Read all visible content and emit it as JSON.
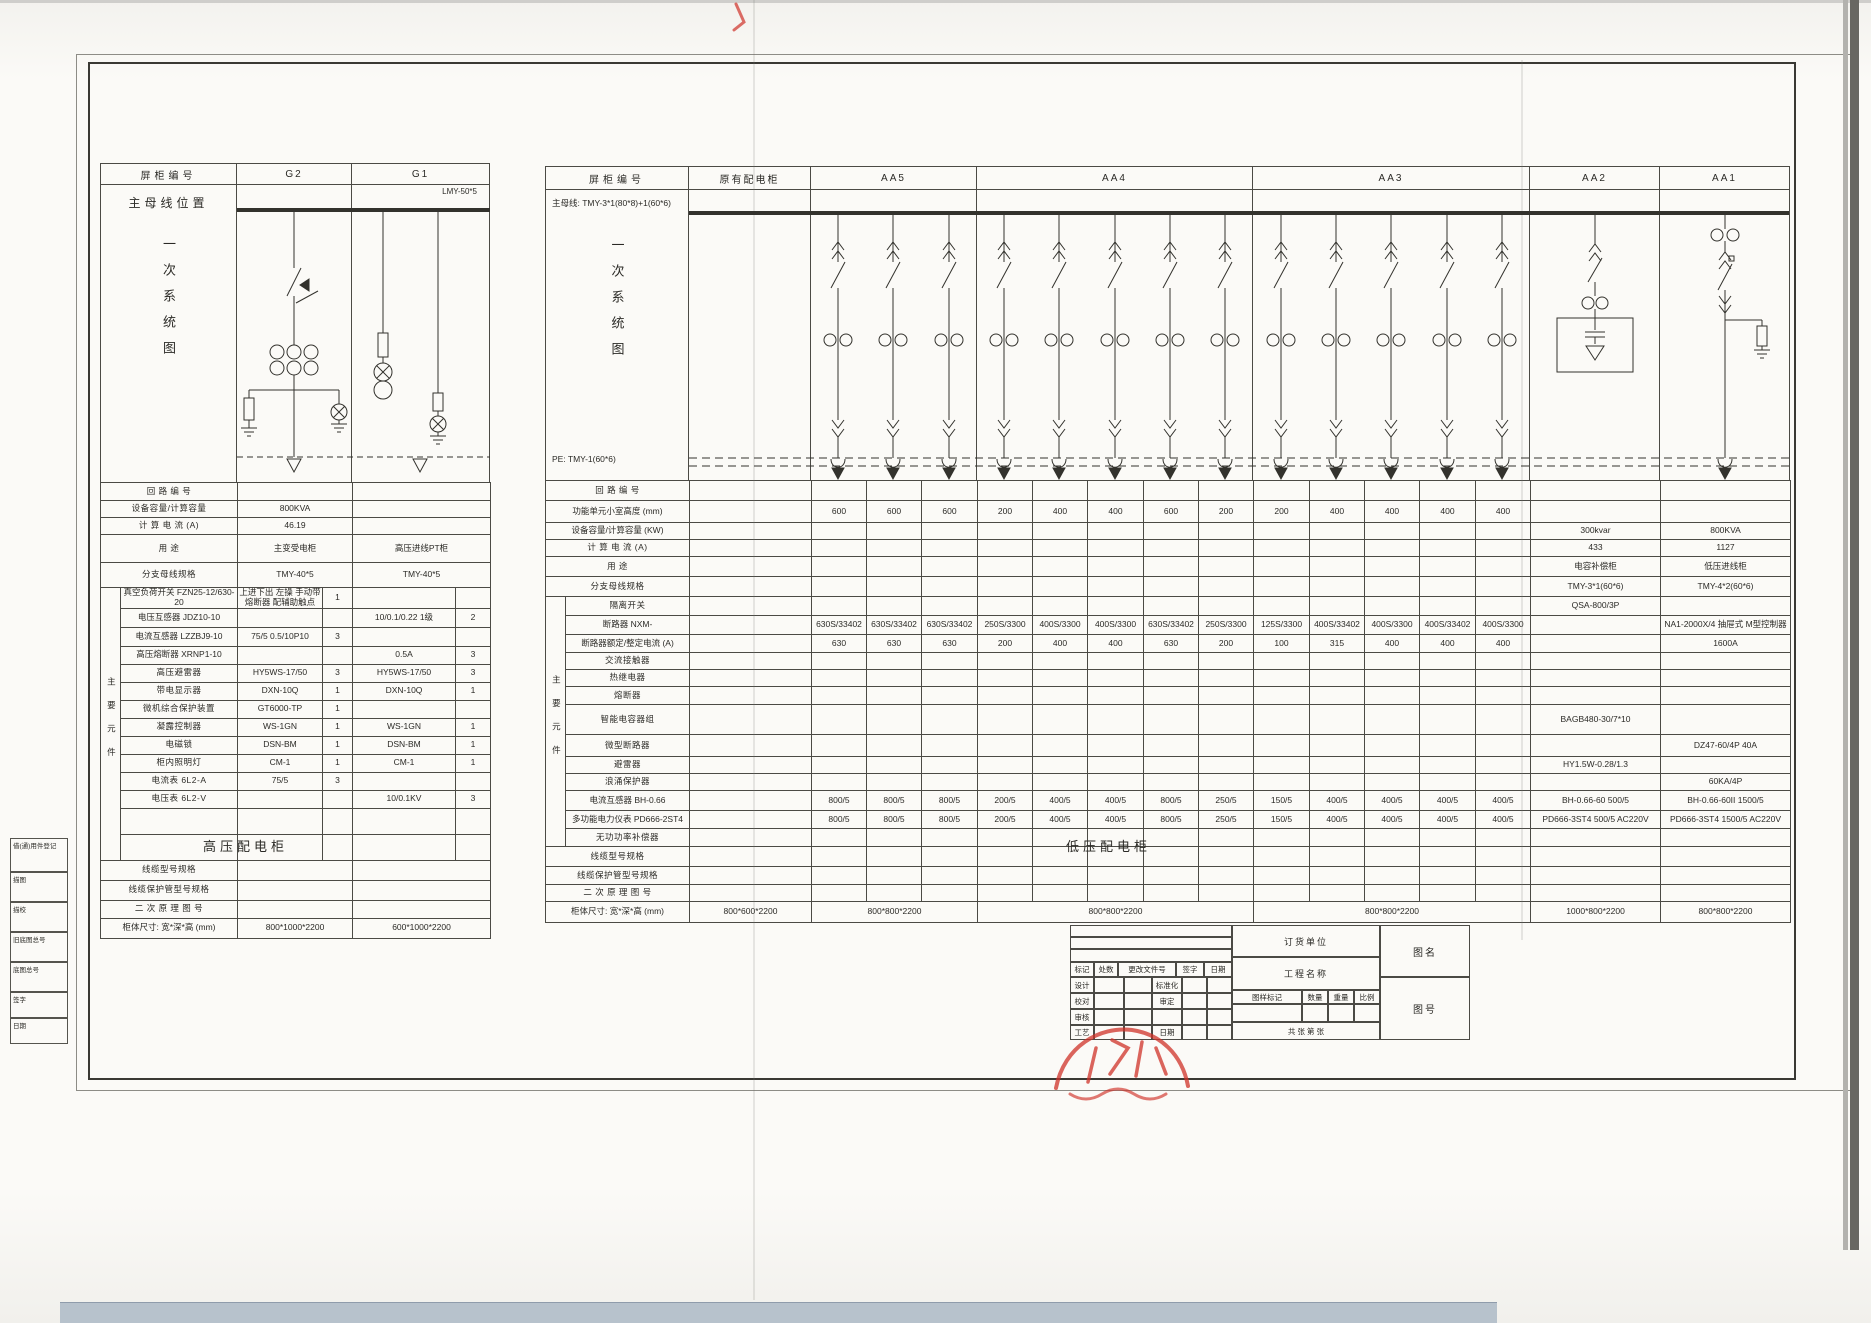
{
  "captions": {
    "hv": "高压配电柜",
    "lv": "低压配电柜"
  },
  "hv": {
    "header": {
      "col_label": "屏柜编号",
      "g2": "G2",
      "g1": "G1"
    },
    "busbar_position_label": "主母线位置",
    "busbar_tag": "LMY-50*5",
    "vertical_title": "一次系统图",
    "group_label": "主要元件",
    "rows": [
      {
        "type": "plain",
        "label": "回 路 编 号",
        "g2": "",
        "g1": "",
        "h": 18
      },
      {
        "type": "plain",
        "label": "设备容量/计算容量",
        "g2": "800KVA",
        "g1": "",
        "h": 17
      },
      {
        "type": "plain",
        "label": "计 算 电 流 (A)",
        "g2": "46.19",
        "g1": "",
        "h": 17
      },
      {
        "type": "plain",
        "label": "用  途",
        "g2": "主变受电柜",
        "g1": "高压进线PT柜",
        "h": 28
      },
      {
        "type": "plain",
        "label": "分支母线规格",
        "g2": "TMY-40*5",
        "g1": "TMY-40*5",
        "h": 25
      },
      {
        "type": "comp",
        "label": "真空负荷开关  FZN25-12/630-20",
        "g2": "上进下出 左操 手动带熔断器 配辅助触点",
        "g2q": "1",
        "g1": "",
        "g1q": "",
        "h": 19,
        "small": true
      },
      {
        "type": "comp",
        "label": "电压互感器  JDZ10-10",
        "g2": "",
        "g2q": "",
        "g1": "10/0.1/0.22 1级",
        "g1q": "2",
        "h": 19
      },
      {
        "type": "comp",
        "label": "电流互感器  LZZBJ9-10",
        "g2": "75/5 0.5/10P10",
        "g2q": "3",
        "g1": "",
        "g1q": "",
        "h": 19
      },
      {
        "type": "comp",
        "label": "高压熔断器  XRNP1-10",
        "g2": "",
        "g2q": "",
        "g1": "0.5A",
        "g1q": "3",
        "h": 18
      },
      {
        "type": "comp",
        "label": "高压避雷器",
        "g2": "HY5WS-17/50",
        "g2q": "3",
        "g1": "HY5WS-17/50",
        "g1q": "3",
        "h": 18
      },
      {
        "type": "comp",
        "label": "带电显示器",
        "g2": "DXN-10Q",
        "g2q": "1",
        "g1": "DXN-10Q",
        "g1q": "1",
        "h": 18
      },
      {
        "type": "comp",
        "label": "微机综合保护装置",
        "g2": "GT6000-TP",
        "g2q": "1",
        "g1": "",
        "g1q": "",
        "h": 18
      },
      {
        "type": "comp",
        "label": "凝露控制器",
        "g2": "WS-1GN",
        "g2q": "1",
        "g1": "WS-1GN",
        "g1q": "1",
        "h": 18
      },
      {
        "type": "comp",
        "label": "电磁锁",
        "g2": "DSN-BM",
        "g2q": "1",
        "g1": "DSN-BM",
        "g1q": "1",
        "h": 18
      },
      {
        "type": "comp",
        "label": "柜内照明灯",
        "g2": "CM-1",
        "g2q": "1",
        "g1": "CM-1",
        "g1q": "1",
        "h": 18
      },
      {
        "type": "comp",
        "label": "电流表  6L2-A",
        "g2": "75/5",
        "g2q": "3",
        "g1": "",
        "g1q": "",
        "h": 18
      },
      {
        "type": "comp",
        "label": "电压表  6L2-V",
        "g2": "",
        "g2q": "",
        "g1": "10/0.1KV",
        "g1q": "3",
        "h": 18
      },
      {
        "type": "comp",
        "label": "",
        "g2": "",
        "g2q": "",
        "g1": "",
        "g1q": "",
        "h": 26
      },
      {
        "type": "comp",
        "label": "",
        "g2": "",
        "g2q": "",
        "g1": "",
        "g1q": "",
        "h": 26
      },
      {
        "type": "plain",
        "label": "线缆型号规格",
        "g2": "",
        "g1": "",
        "h": 20
      },
      {
        "type": "plain",
        "label": "线缆保护管型号规格",
        "g2": "",
        "g1": "",
        "h": 20
      },
      {
        "type": "plain",
        "label": "二 次 原 理 图 号",
        "g2": "",
        "g1": "",
        "h": 18
      },
      {
        "type": "plain",
        "label": "柜体尺寸: 宽*深*高 (mm)",
        "g2": "800*1000*2200",
        "g1": "600*1000*2200",
        "h": 20
      }
    ]
  },
  "lv": {
    "header": {
      "col_label": "屏柜编号",
      "groups": [
        "原有配电柜",
        "AA5",
        "AA4",
        "AA3",
        "AA2",
        "AA1"
      ]
    },
    "busbar_label": "主母线: TMY-3*1(80*8)+1(60*6)",
    "pe_label": "PE: TMY-1(60*6)",
    "vertical_title": "一次系统图",
    "group_label": "主要元件",
    "rows": [
      {
        "type": "plain",
        "label": "回 路 编 号",
        "cells": [],
        "h": 20
      },
      {
        "type": "plain",
        "label": "功能单元小室高度 (mm)",
        "cells": [
          "",
          "600",
          "600",
          "600",
          "200",
          "400",
          "400",
          "600",
          "200",
          "200",
          "400",
          "400",
          "400",
          "400",
          "",
          ""
        ],
        "h": 22
      },
      {
        "type": "plain",
        "label": "设备容量/计算容量 (KW)",
        "cells": [
          "",
          "",
          "",
          "",
          "",
          "",
          "",
          "",
          "",
          "",
          "",
          "",
          "",
          "",
          "300kvar",
          "800KVA"
        ],
        "h": 17
      },
      {
        "type": "plain",
        "label": "计 算 电 流 (A)",
        "cells": [
          "",
          "",
          "",
          "",
          "",
          "",
          "",
          "",
          "",
          "",
          "",
          "",
          "",
          "",
          "433",
          "1127"
        ],
        "h": 17
      },
      {
        "type": "plain",
        "label": "用  途",
        "cells": [
          "",
          "",
          "",
          "",
          "",
          "",
          "",
          "",
          "",
          "",
          "",
          "",
          "",
          "",
          "电容补偿柜",
          "低压进线柜"
        ],
        "h": 20
      },
      {
        "type": "plain",
        "label": "分支母线规格",
        "cells": [
          "",
          "",
          "",
          "",
          "",
          "",
          "",
          "",
          "",
          "",
          "",
          "",
          "",
          "",
          "TMY-3*1(60*6)",
          "TMY-4*2(60*6)"
        ],
        "h": 20
      },
      {
        "type": "comp",
        "label": "隔离开关",
        "cells": [
          "",
          "",
          "",
          "",
          "",
          "",
          "",
          "",
          "",
          "",
          "",
          "",
          "",
          "",
          "QSA-800/3P",
          ""
        ],
        "h": 19
      },
      {
        "type": "comp",
        "label": "断路器      NXM-",
        "cells": [
          "",
          "630S/33402",
          "630S/33402",
          "630S/33402",
          "250S/3300",
          "400S/3300",
          "400S/3300",
          "630S/33402",
          "250S/3300",
          "125S/3300",
          "400S/33402",
          "400S/3300",
          "400S/33402",
          "400S/3300",
          "",
          "NA1-2000X/4 抽屉式 M型控制器"
        ],
        "h": 19
      },
      {
        "type": "comp",
        "label": "断路器额定/整定电流 (A)",
        "cells": [
          "",
          "630",
          "630",
          "630",
          "200",
          "400",
          "400",
          "630",
          "200",
          "100",
          "315",
          "400",
          "400",
          "400",
          "",
          "1600A"
        ],
        "h": 18
      },
      {
        "type": "comp",
        "label": "交流接触器",
        "cells": [],
        "h": 17
      },
      {
        "type": "comp",
        "label": "热继电器",
        "cells": [],
        "h": 17
      },
      {
        "type": "comp",
        "label": "熔断器",
        "cells": [],
        "h": 18
      },
      {
        "type": "comp",
        "label": "智能电容器组",
        "cells": [
          "",
          "",
          "",
          "",
          "",
          "",
          "",
          "",
          "",
          "",
          "",
          "",
          "",
          "",
          "BAGB480-30/7*10",
          ""
        ],
        "h": 30
      },
      {
        "type": "comp",
        "label": "微型断路器",
        "cells": [
          "",
          "",
          "",
          "",
          "",
          "",
          "",
          "",
          "",
          "",
          "",
          "",
          "",
          "",
          "",
          "DZ47-60/4P 40A"
        ],
        "h": 22
      },
      {
        "type": "comp",
        "label": "避雷器",
        "cells": [
          "",
          "",
          "",
          "",
          "",
          "",
          "",
          "",
          "",
          "",
          "",
          "",
          "",
          "",
          "HY1.5W-0.28/1.3",
          ""
        ],
        "h": 17
      },
      {
        "type": "comp",
        "label": "浪涌保护器",
        "cells": [
          "",
          "",
          "",
          "",
          "",
          "",
          "",
          "",
          "",
          "",
          "",
          "",
          "",
          "",
          "",
          "60KA/4P"
        ],
        "h": 17
      },
      {
        "type": "comp",
        "label": "电流互感器   BH-0.66",
        "cells": [
          "",
          "800/5",
          "800/5",
          "800/5",
          "200/5",
          "400/5",
          "400/5",
          "800/5",
          "250/5",
          "150/5",
          "400/5",
          "400/5",
          "400/5",
          "400/5",
          "BH-0.66-60 500/5",
          "BH-0.66-60II 1500/5"
        ],
        "h": 20
      },
      {
        "type": "comp",
        "label": "多功能电力仪表 PD666-2ST4",
        "cells": [
          "",
          "800/5",
          "800/5",
          "800/5",
          "200/5",
          "400/5",
          "400/5",
          "800/5",
          "250/5",
          "150/5",
          "400/5",
          "400/5",
          "400/5",
          "400/5",
          "PD666-3ST4 500/5 AC220V",
          "PD666-3ST4 1500/5 AC220V"
        ],
        "h": 18
      },
      {
        "type": "comp",
        "label": "无功功率补偿器",
        "cells": [],
        "h": 18
      },
      {
        "type": "plain",
        "label": "线缆型号规格",
        "cells": [],
        "h": 20
      },
      {
        "type": "plain",
        "label": "线缆保护管型号规格",
        "cells": [],
        "h": 18
      },
      {
        "type": "plain",
        "label": "二 次 原 理 图 号",
        "cells": [],
        "h": 17
      },
      {
        "type": "plain",
        "label": "柜体尺寸: 宽*深*高 (mm)",
        "spans": [
          {
            "w": 1,
            "t": "800*600*2200"
          },
          {
            "w": 3,
            "t": "800*800*2200"
          },
          {
            "w": 5,
            "t": "800*800*2200"
          },
          {
            "w": 5,
            "t": "800*800*2200"
          },
          {
            "w": 1,
            "t": "1000*800*2200"
          },
          {
            "w": 1,
            "t": "800*800*2200"
          }
        ],
        "h": 21
      }
    ]
  },
  "title_block": {
    "rev_header": [
      "标记",
      "处数",
      "更改文件号",
      "签字",
      "日期"
    ],
    "staff_rows": [
      [
        "设计",
        "",
        "",
        "标准化",
        "",
        ""
      ],
      [
        "校对",
        "",
        "",
        "审定",
        "",
        ""
      ],
      [
        "审核",
        "",
        "",
        "",
        "",
        ""
      ],
      [
        "工艺",
        "",
        "",
        "日期",
        "",
        ""
      ]
    ],
    "order_label": "订货单位",
    "project_label": "工程名称",
    "mark_label": "图样标记",
    "qty_label": "数量",
    "weight_label": "重量",
    "scale_label": "比例",
    "sheet_label": "共  张  第  张",
    "name_label": "图名",
    "no_label": "图号"
  },
  "margin_blocks": {
    "items": [
      "借(通)用件登记",
      "描图",
      "描校",
      "旧底图总号",
      "底图总号",
      "签字",
      "日期"
    ]
  }
}
